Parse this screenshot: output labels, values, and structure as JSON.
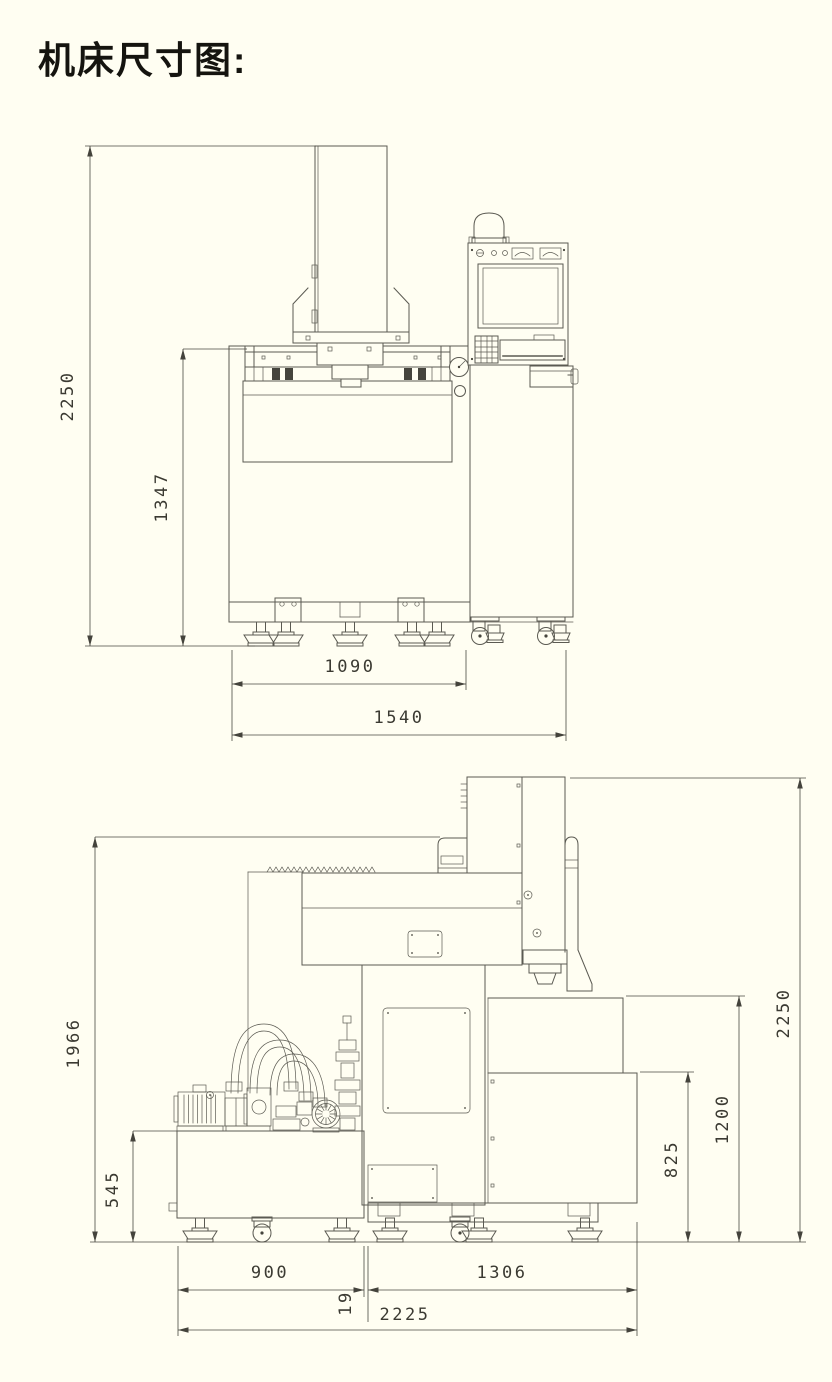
{
  "title": "机床尺寸图:",
  "front_view": {
    "label": "machine front view",
    "dims": {
      "total_height": "2250",
      "upper_height": "1347",
      "foot_span_width": "1090",
      "total_width": "1540"
    }
  },
  "side_view": {
    "label": "machine side view",
    "dims": {
      "height_to_head_top": "1966",
      "tank_height": "545",
      "total_height": "2250",
      "worktank_top_height": "1200",
      "bed_height": "825",
      "tank_width": "900",
      "base_depth": "1306",
      "gap": "19",
      "total_depth": "2225"
    }
  },
  "colors": {
    "background": "#fffef2",
    "line": "#5b5a52",
    "dimension_line": "#4a4940",
    "dimension_text": "#3b3a32",
    "title_text": "#15140f"
  }
}
